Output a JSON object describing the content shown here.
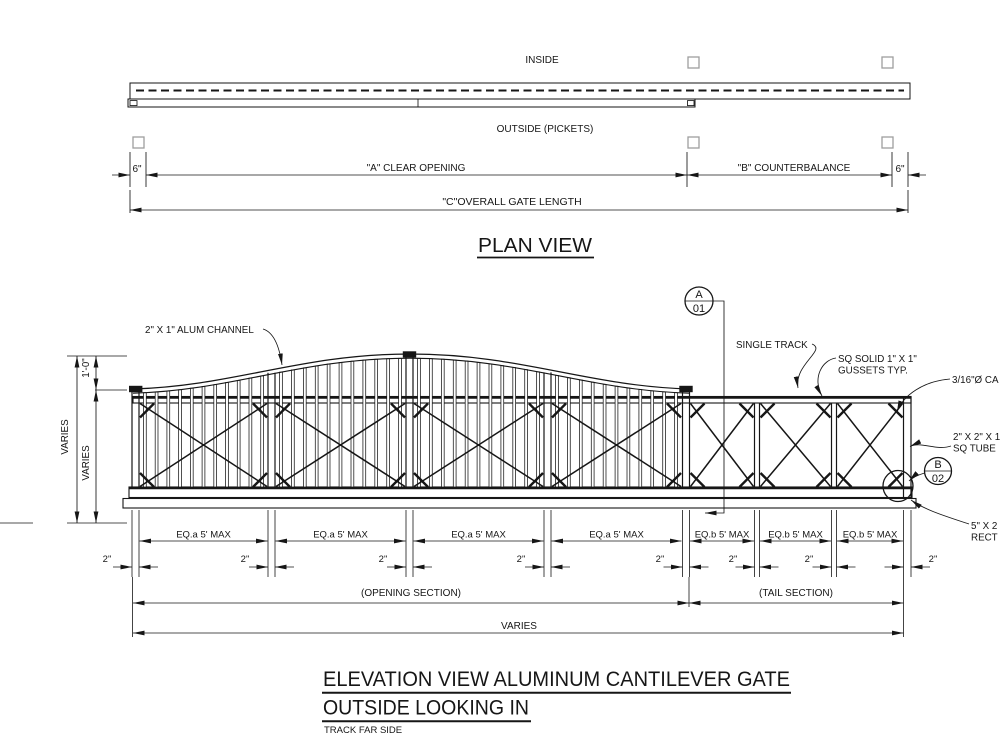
{
  "plan": {
    "inside_label": "INSIDE",
    "outside_label": "OUTSIDE (PICKETS)",
    "dim_left_6": "6\"",
    "dim_a": "\"A\" CLEAR OPENING",
    "dim_b": "\"B\" COUNTERBALANCE",
    "dim_right_6": "6\"",
    "dim_overall": "\"C\"OVERALL GATE LENGTH",
    "title": "PLAN VIEW"
  },
  "elevation": {
    "labels": {
      "channel": "2\" X 1\" ALUM CHANNEL",
      "single_track": "SINGLE TRACK",
      "gussets_line1": "SQ SOLID 1\" X 1\"",
      "gussets_line2": "GUSSETS TYP.",
      "cable": "3/16\"Ø CA",
      "sq_tube_line1": "2\" X 2\" X 1",
      "sq_tube_line2": "SQ TUBE",
      "rect_tube_line1": "5\" X 2",
      "rect_tube_line2": "RECT",
      "callout_a_letter": "A",
      "callout_a_number": "01",
      "callout_b_letter": "B",
      "callout_b_number": "02"
    },
    "dims": {
      "arch_rise": "1'-0\"",
      "height_overall": "VARIES",
      "height_frame": "VARIES",
      "bay_labels": [
        "EQ.a 5' MAX",
        "EQ.a 5' MAX",
        "EQ.a 5' MAX",
        "EQ.a 5' MAX",
        "EQ.b 5' MAX",
        "EQ.b 5' MAX",
        "EQ.b 5' MAX"
      ],
      "post_width": "2\"",
      "opening_section": "(OPENING SECTION)",
      "tail_section": "(TAIL SECTION)",
      "overall_length": "VARIES"
    },
    "geometry": {
      "opening_posts": {
        "centers": [
          135.5,
          271.5,
          409.5,
          547.5,
          686
        ],
        "half_width": 3.5
      },
      "tail_posts": {
        "centers": [
          757,
          834
        ],
        "half_width": 2.5
      },
      "right_post": {
        "x1": 903.5,
        "x2": 911
      },
      "rails": {
        "top_y1": 396.5,
        "top_y2": 403,
        "top_left": 133,
        "top_right": 911,
        "bot_y1": 487,
        "bot_y2": 497.5,
        "bot_left": 129,
        "bot_right": 912,
        "track_y1": 498.5,
        "track_y2": 508,
        "track_left": 123,
        "track_right": 916
      },
      "arch_ctrl_left": [
        [
          133,
          389
        ],
        [
          235,
          386
        ],
        [
          300,
          354
        ],
        [
          410,
          354
        ]
      ],
      "arch_ctrl_right": [
        [
          410,
          354
        ],
        [
          520,
          354
        ],
        [
          587,
          386
        ],
        [
          689,
          389
        ]
      ],
      "arch_thickness": 4.2,
      "bays_opening": [
        [
          139,
          268
        ],
        [
          275,
          406
        ],
        [
          413,
          544
        ],
        [
          551,
          682
        ]
      ],
      "bays_tail": [
        [
          689.5,
          754.5
        ],
        [
          759.5,
          831.5
        ],
        [
          836.5,
          903.5
        ]
      ],
      "picket_pitch": 11.6,
      "picket_width": 2.8,
      "caps": [
        [
          129,
          385.8,
          13.4,
          6.4
        ],
        [
          402.8,
          351.3,
          13.4,
          6.4
        ],
        [
          679.3,
          385.8,
          13.4,
          6.4
        ]
      ],
      "post_edges": [
        [
          132,
          139
        ],
        [
          268,
          275
        ],
        [
          406,
          413
        ],
        [
          544,
          551
        ],
        [
          682.5,
          689.5
        ],
        [
          754.5,
          759.5
        ],
        [
          831.5,
          836.5
        ],
        [
          903.5,
          911
        ]
      ],
      "dim_rows": {
        "ext_top": 510,
        "ext_bot": 577,
        "row1_y": 541,
        "row2_y": 567,
        "row3_y": 603,
        "row4_y": 633,
        "sect_left": 133,
        "sect_mid": 689,
        "sect_right": 903.5,
        "long_ext_bot": 637,
        "mid_ext_bot": 607
      }
    },
    "titles": {
      "line1": "ELEVATION VIEW ALUMINUM CANTILEVER GATE",
      "line2": "OUTSIDE LOOKING IN",
      "note": "TRACK FAR SIDE"
    }
  }
}
